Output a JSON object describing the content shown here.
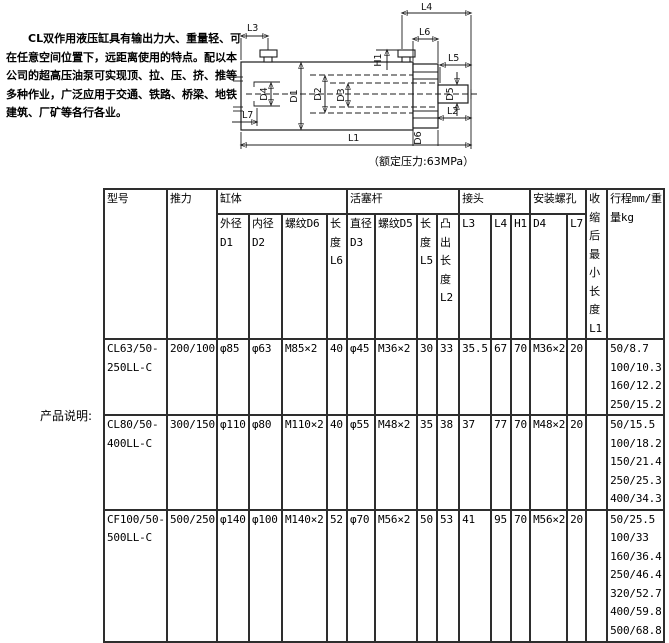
{
  "intro": {
    "text": "CL双作用液压缸具有输出力大、重量轻、可在任意空间位置下，远距离使用的特点。配以本公司的超高压油泵可实现顶、拉、压、挤、推等多种作业，广泛应用于交通、铁路、桥梁、地铁建筑、厂矿等各行各业。"
  },
  "side_label": "产品说明:",
  "diagram": {
    "note": "（额定压力:63MPa）",
    "labels": {
      "l1": "L1",
      "l2": "L2",
      "l3": "L3",
      "l4": "L4",
      "l5": "L5",
      "l6": "L6",
      "l7": "L7",
      "h1": "H1",
      "d1": "D1",
      "d2": "D2",
      "d3": "D3",
      "d4": "D4",
      "d5": "D5",
      "d6": "D6"
    }
  },
  "table": {
    "groups": {
      "model": "型号",
      "thrust": "推力",
      "cylinder": "缸体",
      "piston_rod": "活塞杆",
      "joint": "接头",
      "mount_holes": "安装螺孔",
      "min_length": "收缩后最小长度L1",
      "stroke_weight": "行程mm/重量kg"
    },
    "subheaders": {
      "outer_dia": "外径D1",
      "inner_dia": "内径D2",
      "thread_d6": "螺纹D6",
      "length_l6": "长度L6",
      "rod_dia": "直径D3",
      "thread_d5": "螺纹D5",
      "length_l5": "长度L5",
      "protrude_l2": "凸出长度L2",
      "l3": "L3",
      "l4": "L4",
      "h1": "H1",
      "d4": "D4",
      "l7": "L7"
    },
    "rows": [
      {
        "model": "CL63/50-250LL-C",
        "thrust": "200/100",
        "d1": "φ85",
        "d2": "φ63",
        "thread_d6": "M85×2",
        "l6": "40",
        "d3": "φ45",
        "thread_d5": "M36×2",
        "l5": "30",
        "l2": "33",
        "l3": "35.5",
        "l4": "67",
        "h1": "70",
        "d4": "M36×2",
        "l7": "20",
        "l1": "",
        "stroke_weight": [
          "50/8.7",
          "100/10.3",
          "160/12.2",
          "250/15.2"
        ]
      },
      {
        "model": "CL80/50-400LL-C",
        "thrust": "300/150",
        "d1": "φ110",
        "d2": "φ80",
        "thread_d6": "M110×2",
        "l6": "40",
        "d3": "φ55",
        "thread_d5": "M48×2",
        "l5": "35",
        "l2": "38",
        "l3": "37",
        "l4": "77",
        "h1": "70",
        "d4": "M48×2",
        "l7": "20",
        "l1": "",
        "stroke_weight": [
          "50/15.5",
          "100/18.2",
          "150/21.4",
          "250/25.3",
          "400/34.3"
        ]
      },
      {
        "model": "CF100/50-500LL-C",
        "thrust": "500/250",
        "d1": "φ140",
        "d2": "φ100",
        "thread_d6": "M140×2",
        "l6": "52",
        "d3": "φ70",
        "thread_d5": "M56×2",
        "l5": "50",
        "l2": "53",
        "l3": "41",
        "l4": "95",
        "h1": "70",
        "d4": "M56×2",
        "l7": "20",
        "l1": "",
        "stroke_weight": [
          "50/25.5",
          "100/33",
          "160/36.4",
          "250/46.4",
          "320/52.7",
          "400/59.8",
          "500/68.8"
        ]
      }
    ]
  }
}
